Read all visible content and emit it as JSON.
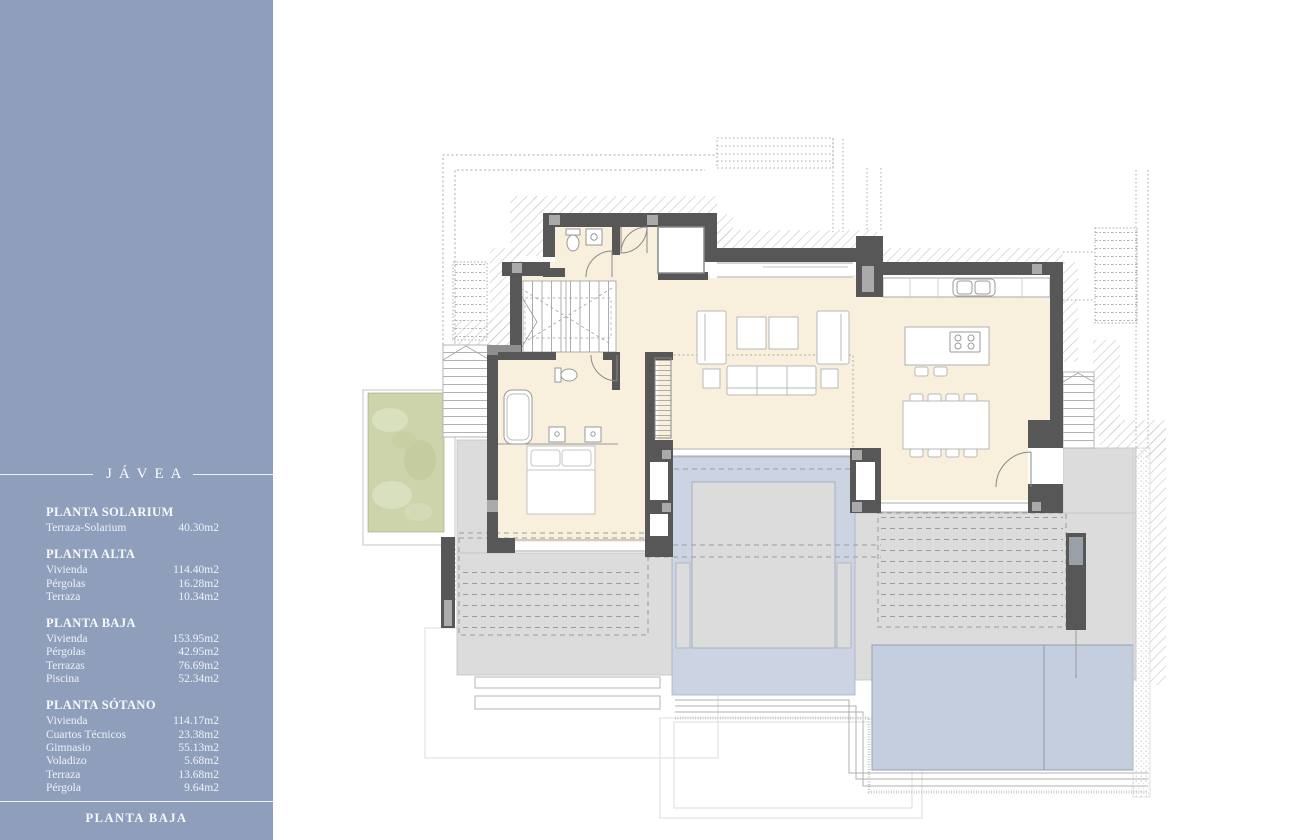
{
  "sidebar": {
    "background_color": "#8f9fbb",
    "text_color": "#f3f6fa",
    "title": "JÁVEA",
    "sections": [
      {
        "header": "PLANTA SOLARIUM",
        "rows": [
          {
            "label": "Terraza-Solarium",
            "value": "40.30m2"
          }
        ]
      },
      {
        "header": "PLANTA ALTA",
        "rows": [
          {
            "label": "Vivienda",
            "value": "114.40m2"
          },
          {
            "label": "Pérgolas",
            "value": "16.28m2"
          },
          {
            "label": "Terraza",
            "value": "10.34m2"
          }
        ]
      },
      {
        "header": "PLANTA BAJA",
        "rows": [
          {
            "label": "Vivienda",
            "value": "153.95m2"
          },
          {
            "label": "Pérgolas",
            "value": "42.95m2"
          },
          {
            "label": "Terrazas",
            "value": "76.69m2"
          },
          {
            "label": "Piscina",
            "value": "52.34m2"
          }
        ]
      },
      {
        "header": "PLANTA SÓTANO",
        "rows": [
          {
            "label": "Vivienda",
            "value": "114.17m2"
          },
          {
            "label": "Cuartos Técnicos",
            "value": "23.38m2"
          },
          {
            "label": "Gimnasio",
            "value": "55.13m2"
          },
          {
            "label": "Voladizo",
            "value": "5.68m2"
          },
          {
            "label": "Terraza",
            "value": "13.68m2"
          },
          {
            "label": "Pérgola",
            "value": "9.64m2"
          }
        ]
      }
    ],
    "footer": "PLANTA BAJA"
  },
  "plan": {
    "colors": {
      "wall": "#575757",
      "pillar": "#aaaaaa",
      "interior_floor": "#f8f0dd",
      "terrace": "#dcdcdc",
      "pool": "#c4cede",
      "water_patio": "#ccd4e3",
      "garden": "#cdd4ac",
      "hatch": "#cacaca",
      "dash": "#9b9b9b"
    }
  }
}
